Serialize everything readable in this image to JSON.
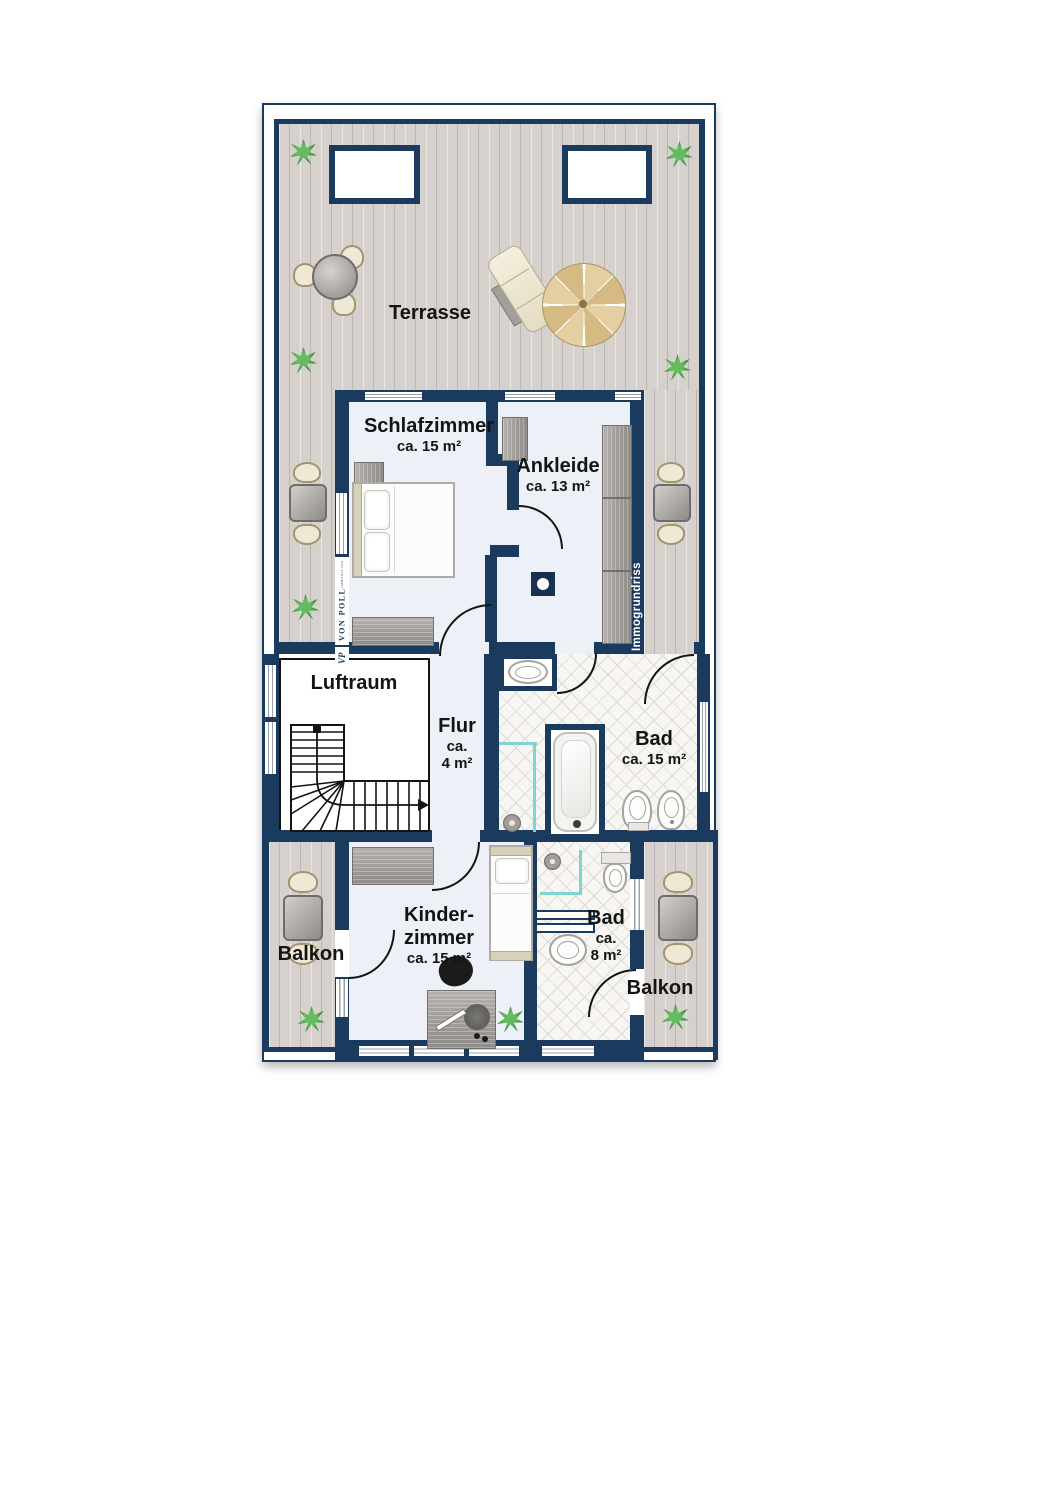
{
  "rooms": {
    "terrasse": {
      "label": "Terrasse"
    },
    "schlafzimmer": {
      "label": "Schlafzimmer",
      "area": "ca. 15 m²"
    },
    "ankleide": {
      "label": "Ankleide",
      "area": "ca. 13 m²"
    },
    "luftraum": {
      "label": "Luftraum"
    },
    "flur": {
      "label": "Flur",
      "area_line1": "ca.",
      "area_line2": "4 m²"
    },
    "bad": {
      "label": "Bad",
      "area": "ca. 15 m²"
    },
    "kinderzimmer": {
      "label_line1": "Kinder-",
      "label_line2": "zimmer",
      "area": "ca. 15 m²"
    },
    "bad_klein": {
      "label": "Bad",
      "area_line1": "ca.",
      "area_line2": "8 m²"
    },
    "balkon_links": {
      "label": "Balkon"
    },
    "balkon_rechts": {
      "label": "Balkon"
    }
  },
  "watermarks": {
    "brand_name": "VON POLL",
    "brand_sub": "IMMOBILIEN",
    "brand_monogram": "VP",
    "plan_credit": "Immogrundriss"
  },
  "colors": {
    "wall": "#1a3a5e",
    "wood_deck": "#d7d1ce",
    "room_floor": "#edf0f6",
    "tile_line": "#ddd9d3",
    "shower_glass": "#7fd4cf",
    "plant_green": "#2f9034"
  },
  "symbols": [
    "plant-icon",
    "staircase-up-arrow",
    "double-bed",
    "single-bed",
    "wardrobe",
    "dresser",
    "bathtub",
    "shower",
    "washbasin",
    "toilet",
    "bidet",
    "desk",
    "desk-chair",
    "dining-table",
    "bistro-table",
    "lounger",
    "parasol",
    "skylight",
    "chimney"
  ]
}
